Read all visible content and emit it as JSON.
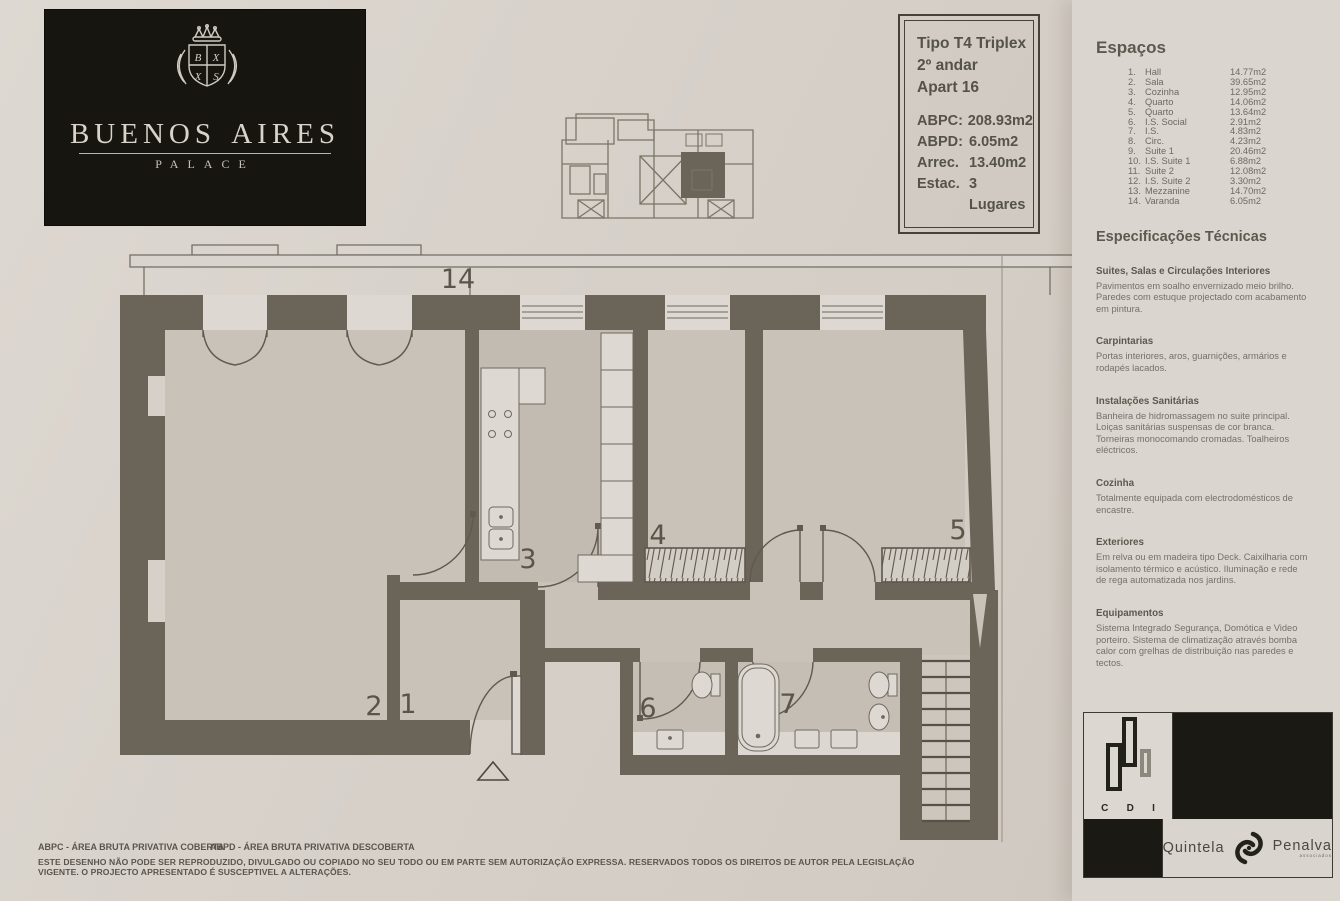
{
  "brand": {
    "name": "Buenos Aires",
    "subtitle": "PALACE"
  },
  "info_box": {
    "type": "Tipo T4 Triplex",
    "floor": "2º andar",
    "apartment": "Apart 16",
    "specs": [
      {
        "label": "ABPC:",
        "value": "208.93m2"
      },
      {
        "label": "ABPD:",
        "value": "6.05m2"
      },
      {
        "label": "Arrec.",
        "value": "13.40m2"
      },
      {
        "label": "Estac.",
        "value": "3 Lugares"
      }
    ]
  },
  "espacos": {
    "heading": "Espaços",
    "items": [
      {
        "num": "1.",
        "name": "Hall",
        "area": "14.77m2"
      },
      {
        "num": "2.",
        "name": "Sala",
        "area": "39.65m2"
      },
      {
        "num": "3.",
        "name": "Cozinha",
        "area": "12.95m2"
      },
      {
        "num": "4.",
        "name": "Quarto",
        "area": "14.06m2"
      },
      {
        "num": "5.",
        "name": "Quarto",
        "area": "13.64m2"
      },
      {
        "num": "6.",
        "name": "I.S. Social",
        "area": "2.91m2"
      },
      {
        "num": "7.",
        "name": "I.S.",
        "area": "4.83m2"
      },
      {
        "num": "8.",
        "name": "Circ.",
        "area": "4.23m2"
      },
      {
        "num": "9.",
        "name": "Suite 1",
        "area": "20.46m2"
      },
      {
        "num": "10.",
        "name": "I.S. Suite 1",
        "area": "6.88m2"
      },
      {
        "num": "11.",
        "name": "Suite 2",
        "area": "12.08m2"
      },
      {
        "num": "12.",
        "name": "I.S. Suite 2",
        "area": "3.30m2"
      },
      {
        "num": "13.",
        "name": "Mezzanine",
        "area": "14.70m2"
      },
      {
        "num": "14.",
        "name": "Varanda",
        "area": "6.05m2"
      }
    ]
  },
  "especificacoes": {
    "heading": "Especificações Técnicas",
    "sections": [
      {
        "title": "Suites, Salas e Circulações Interiores",
        "body": "Pavimentos em soalho envernizado meio brilho. Paredes com estuque projectado com acabamento em pintura."
      },
      {
        "title": "Carpintarias",
        "body": "Portas interiores, aros, guarnições, armários e rodapés lacados."
      },
      {
        "title": "Instalações Sanitárias",
        "body": "Banheira de hidromassagem no suite principal. Loiças sanitárias suspensas de cor branca. Torneiras monocomando cromadas. Toalheiros eléctricos."
      },
      {
        "title": "Cozinha",
        "body": "Totalmente equipada com electrodomésticos de encastre."
      },
      {
        "title": "Exteriores",
        "body": "Em relva ou em madeira tipo Deck. Caixilharia com isolamento térmico e acústico. Iluminação e rede de rega automatizada nos jardins."
      },
      {
        "title": "Equipamentos",
        "body": "Sistema Integrado Segurança, Domótica e Video porteiro. Sistema de climatização através bomba calor com grelhas de distribuição nas paredes e tectos."
      }
    ]
  },
  "plan": {
    "labels": {
      "varanda": "14",
      "sala": "2",
      "hall": "1",
      "cozinha": "3",
      "quarto_4": "4",
      "quarto_5": "5",
      "is_social": "6",
      "is_7": "7"
    },
    "colors": {
      "wall": "#6b6459",
      "floor": "#c8c2b9",
      "paper": "#d6d0c9"
    }
  },
  "cdi": {
    "letters": [
      "C",
      "D",
      "I"
    ]
  },
  "agency": {
    "name_left": "Quintela",
    "name_right": "Penalva",
    "tagline": "associados"
  },
  "footer": {
    "abbr1": "ABPC - ÁREA BRUTA PRIVATIVA COBERTA",
    "abbr2": "ABPD - ÁREA BRUTA PRIVATIVA DESCOBERTA",
    "disclaimer": "ESTE DESENHO NÃO PODE SER REPRODUZIDO, DIVULGADO OU COPIADO NO SEU TODO OU EM PARTE SEM AUTORIZAÇÃO EXPRESSA. RESERVADOS TODOS OS DIREITOS DE AUTOR PELA LEGISLAÇÃO VIGENTE. O PROJECTO APRESENTADO É SUSCEPTIVEL A ALTERAÇÕES."
  }
}
